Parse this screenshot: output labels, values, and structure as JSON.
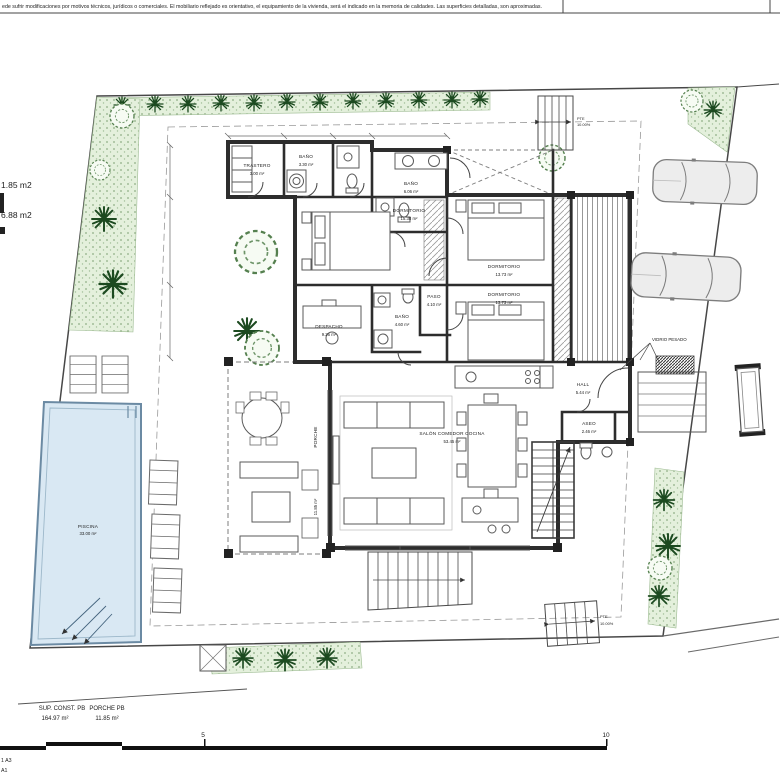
{
  "disclaimer": "ede sufrir modificaciones por motivos técnicos, jurídicos o comerciales. El mobiliario reflejado es orientativo, el equipamiento de la vivienda, será el indicado en la memoria de calidades. Las superficies detalladas, son aproximadas.",
  "site": {
    "left_labels": [
      "1.85 m2",
      "6.88 m2"
    ]
  },
  "rooms": {
    "trastero": {
      "name": "TRASTERO",
      "area": "3.00 m²"
    },
    "bano_a": {
      "name": "BAÑO",
      "area": "3.30 m²"
    },
    "bano_b": {
      "name": "BAÑO",
      "area": "6.06 m²"
    },
    "dorm_a": {
      "name": "DORMITORIO",
      "area": "15.38 m²"
    },
    "dorm_b": {
      "name": "DORMITORIO",
      "area": "13.73 m²"
    },
    "dorm_c": {
      "name": "DORMITORIO",
      "area": "13.73 m²"
    },
    "paso": {
      "name": "PASO",
      "area": "4.10 m²"
    },
    "bano_c": {
      "name": "BAÑO",
      "area": "4.60 m²"
    },
    "despacho": {
      "name": "DESPACHO",
      "area": "9.26 m²"
    },
    "hall": {
      "name": "HALL",
      "area": "5.44 m²"
    },
    "aseo": {
      "name": "ASEO",
      "area": "2.46 m²"
    },
    "salon": {
      "name": "SALÓN COMEDOR COCINA",
      "area": "53.45 m²"
    },
    "piscina": {
      "name": "PISCINA",
      "area": "33.00 m²"
    },
    "porche": {
      "name": "PORCHE",
      "area": "11.85 m²"
    }
  },
  "annotations": {
    "heavy_glass": "VIDRIO PESADO",
    "ramp_top": {
      "l1": "PTE",
      "l2": "10.00%"
    },
    "ramp_bottom": {
      "l1": "PTE",
      "l2": "10.00%"
    }
  },
  "summary": {
    "col1_label": "SUP. CONST. PB",
    "col1_value": "164.97 m²",
    "col2_label": "PORCHE PB",
    "col2_value": "11.85 m²"
  },
  "scale_bar": {
    "tick_mid": "5",
    "tick_end": "10"
  },
  "sheet": {
    "line1": "1 A3",
    "line2": "A1"
  }
}
